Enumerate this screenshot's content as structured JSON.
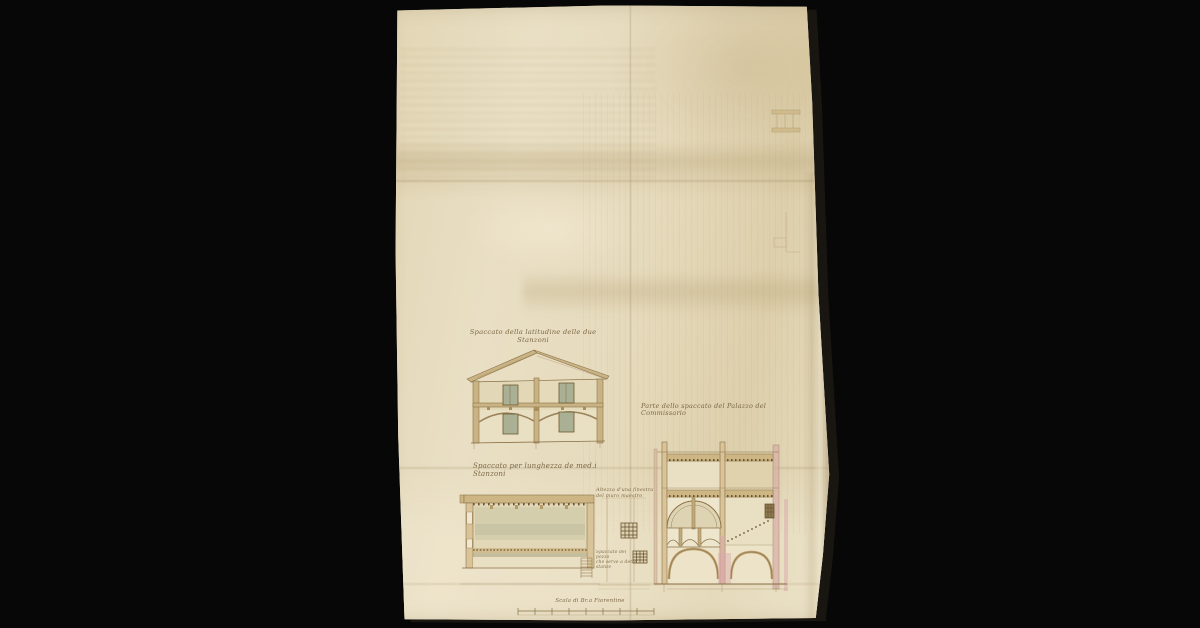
{
  "captions": {
    "house_section_line1": "Spaccato della latitudine delle due",
    "house_section_line2": "Stanzoni",
    "palazzo_section": "Parte dello spaccato del Palazzo del Commissario",
    "long_section": "Spaccato per lunghezza de med.i Stanzoni",
    "window_note_line1": "Altezza d'una finestra",
    "window_note_line2": "del muro maestro",
    "well_note_line1": "Spaccato del pozzo",
    "well_note_line2": "che serve a dette",
    "well_note_line3": "stanze",
    "scale_label": "Scala di Br.a Fiorentine"
  },
  "scale_bar": {
    "divisions": 8
  },
  "colors": {
    "background": "#070707",
    "paper": "#e6dbbc",
    "ink": "#8a7248",
    "wash_tan": "#c9b385",
    "wash_pink": "#d9a9a9",
    "wash_green": "#aab093"
  }
}
